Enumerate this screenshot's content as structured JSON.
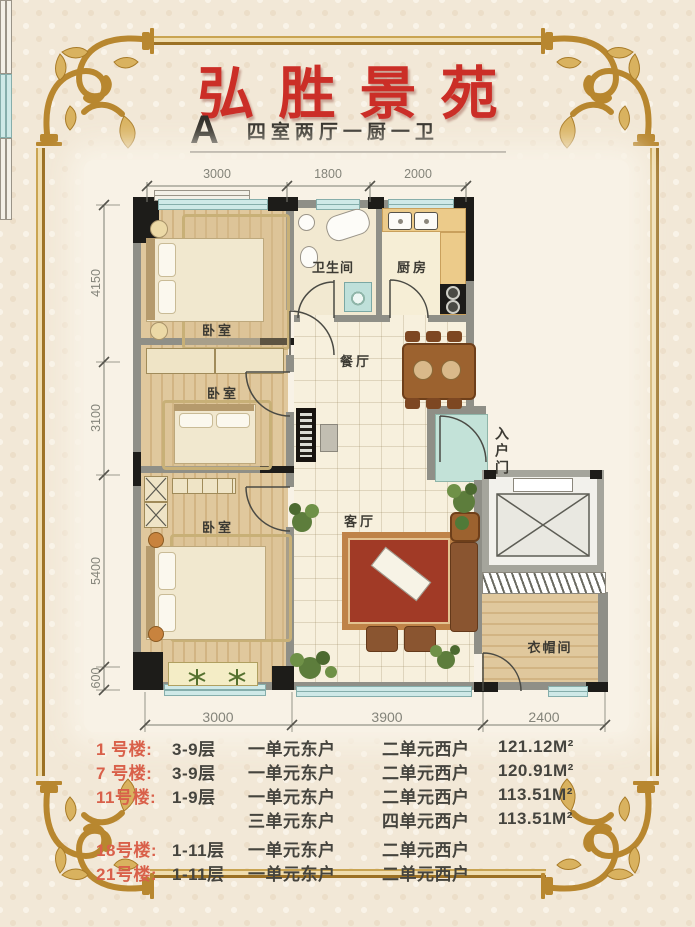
{
  "page": {
    "background": "#f2e8d7",
    "frame_gold": "#b8872f",
    "title_red": "#cb2e27",
    "listing_red": "#d9604a"
  },
  "header": {
    "title": "弘胜景苑",
    "unit_type": "A",
    "unit_layout": "四室两厅一厨一卫"
  },
  "floorplan": {
    "dims_top": [
      "3000",
      "1800",
      "2000"
    ],
    "dims_left": [
      "4150",
      "3100",
      "5400",
      "600"
    ],
    "dims_bottom": [
      "3000",
      "3900",
      "2400"
    ],
    "rooms": {
      "bedroom_top": "卧室",
      "bedroom_middle": "卧室",
      "bedroom_bottom": "卧室",
      "bathroom": "卫生间",
      "kitchen": "厨房",
      "dining": "餐厅",
      "living": "客厅",
      "entry": "入户门",
      "cloakroom": "衣帽间"
    }
  },
  "listings": {
    "rows": [
      {
        "building": "1 号楼:",
        "floors": "3-9层",
        "east": "一单元东户",
        "west": "二单元西户",
        "area": "121.12M²"
      },
      {
        "building": "7 号楼:",
        "floors": "3-9层",
        "east": "一单元东户",
        "west": "二单元西户",
        "area": "120.91M²"
      },
      {
        "building": "11号楼:",
        "floors": "1-9层",
        "east": "一单元东户",
        "west": "二单元西户",
        "area": "113.51M²"
      },
      {
        "building": "",
        "floors": "",
        "east": "三单元东户",
        "west": "四单元西户",
        "area": "113.51M²"
      },
      {
        "building": "18号楼:",
        "floors": "1-11层",
        "east": "一单元东户",
        "west": "二单元西户",
        "area": ""
      },
      {
        "building": "21号楼:",
        "floors": "1-11层",
        "east": "一单元东户",
        "west": "二单元西户",
        "area": ""
      }
    ]
  }
}
